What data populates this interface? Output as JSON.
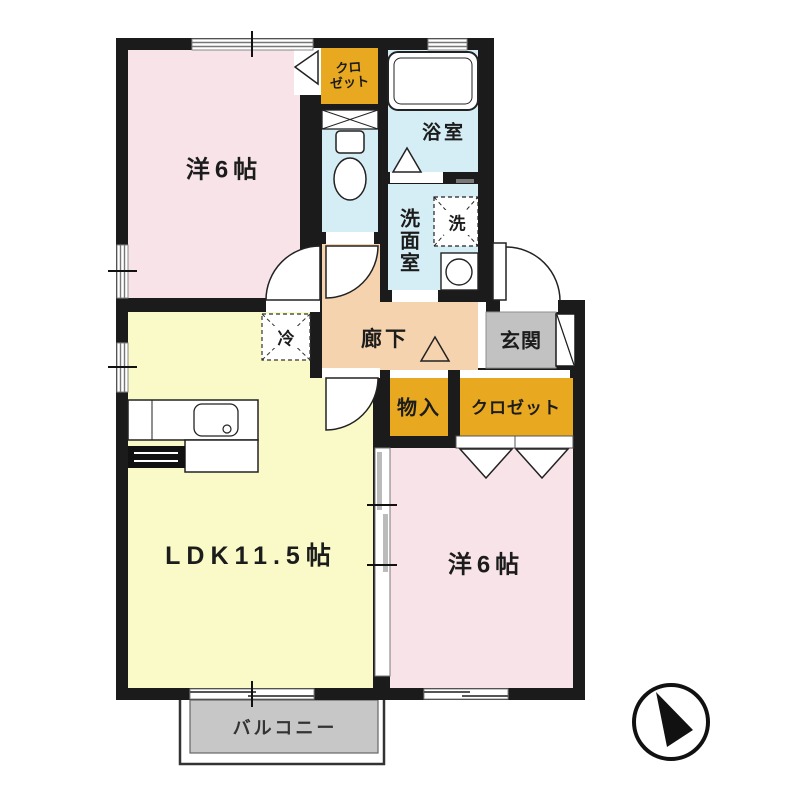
{
  "title": "apartment-floor-plan",
  "rooms": {
    "bedroom_top": {
      "label": "洋6帖"
    },
    "bedroom_bottom": {
      "label": "洋6帖"
    },
    "ldk": {
      "label": "LDK11.5帖"
    },
    "hallway": {
      "label": "廊下"
    },
    "entrance": {
      "label": "玄関"
    },
    "bathroom": {
      "label": "浴室"
    },
    "washroom": {
      "label": "洗面室"
    },
    "balcony": {
      "label": "バルコニー"
    }
  },
  "storage": {
    "closet_top": {
      "label_line1": "クロ",
      "label_line2": "ゼット"
    },
    "closet_bottom": {
      "label": "クロゼット"
    },
    "storage_cabinet": {
      "label": "物入"
    }
  },
  "appliances": {
    "washer": {
      "label": "洗"
    },
    "refrigerator": {
      "label": "冷"
    }
  },
  "icons": {
    "compass": "north-arrow-icon"
  },
  "colors": {
    "wall": "#1b1b1b",
    "bedroom": "#f8e4e8",
    "ldk": "#fafac8",
    "wet_area": "#d5eef5",
    "hallway": "#f5d3ae",
    "closet": "#e8a81f",
    "entrance": "#c2c2c2",
    "balcony": "#c7c7c7"
  }
}
